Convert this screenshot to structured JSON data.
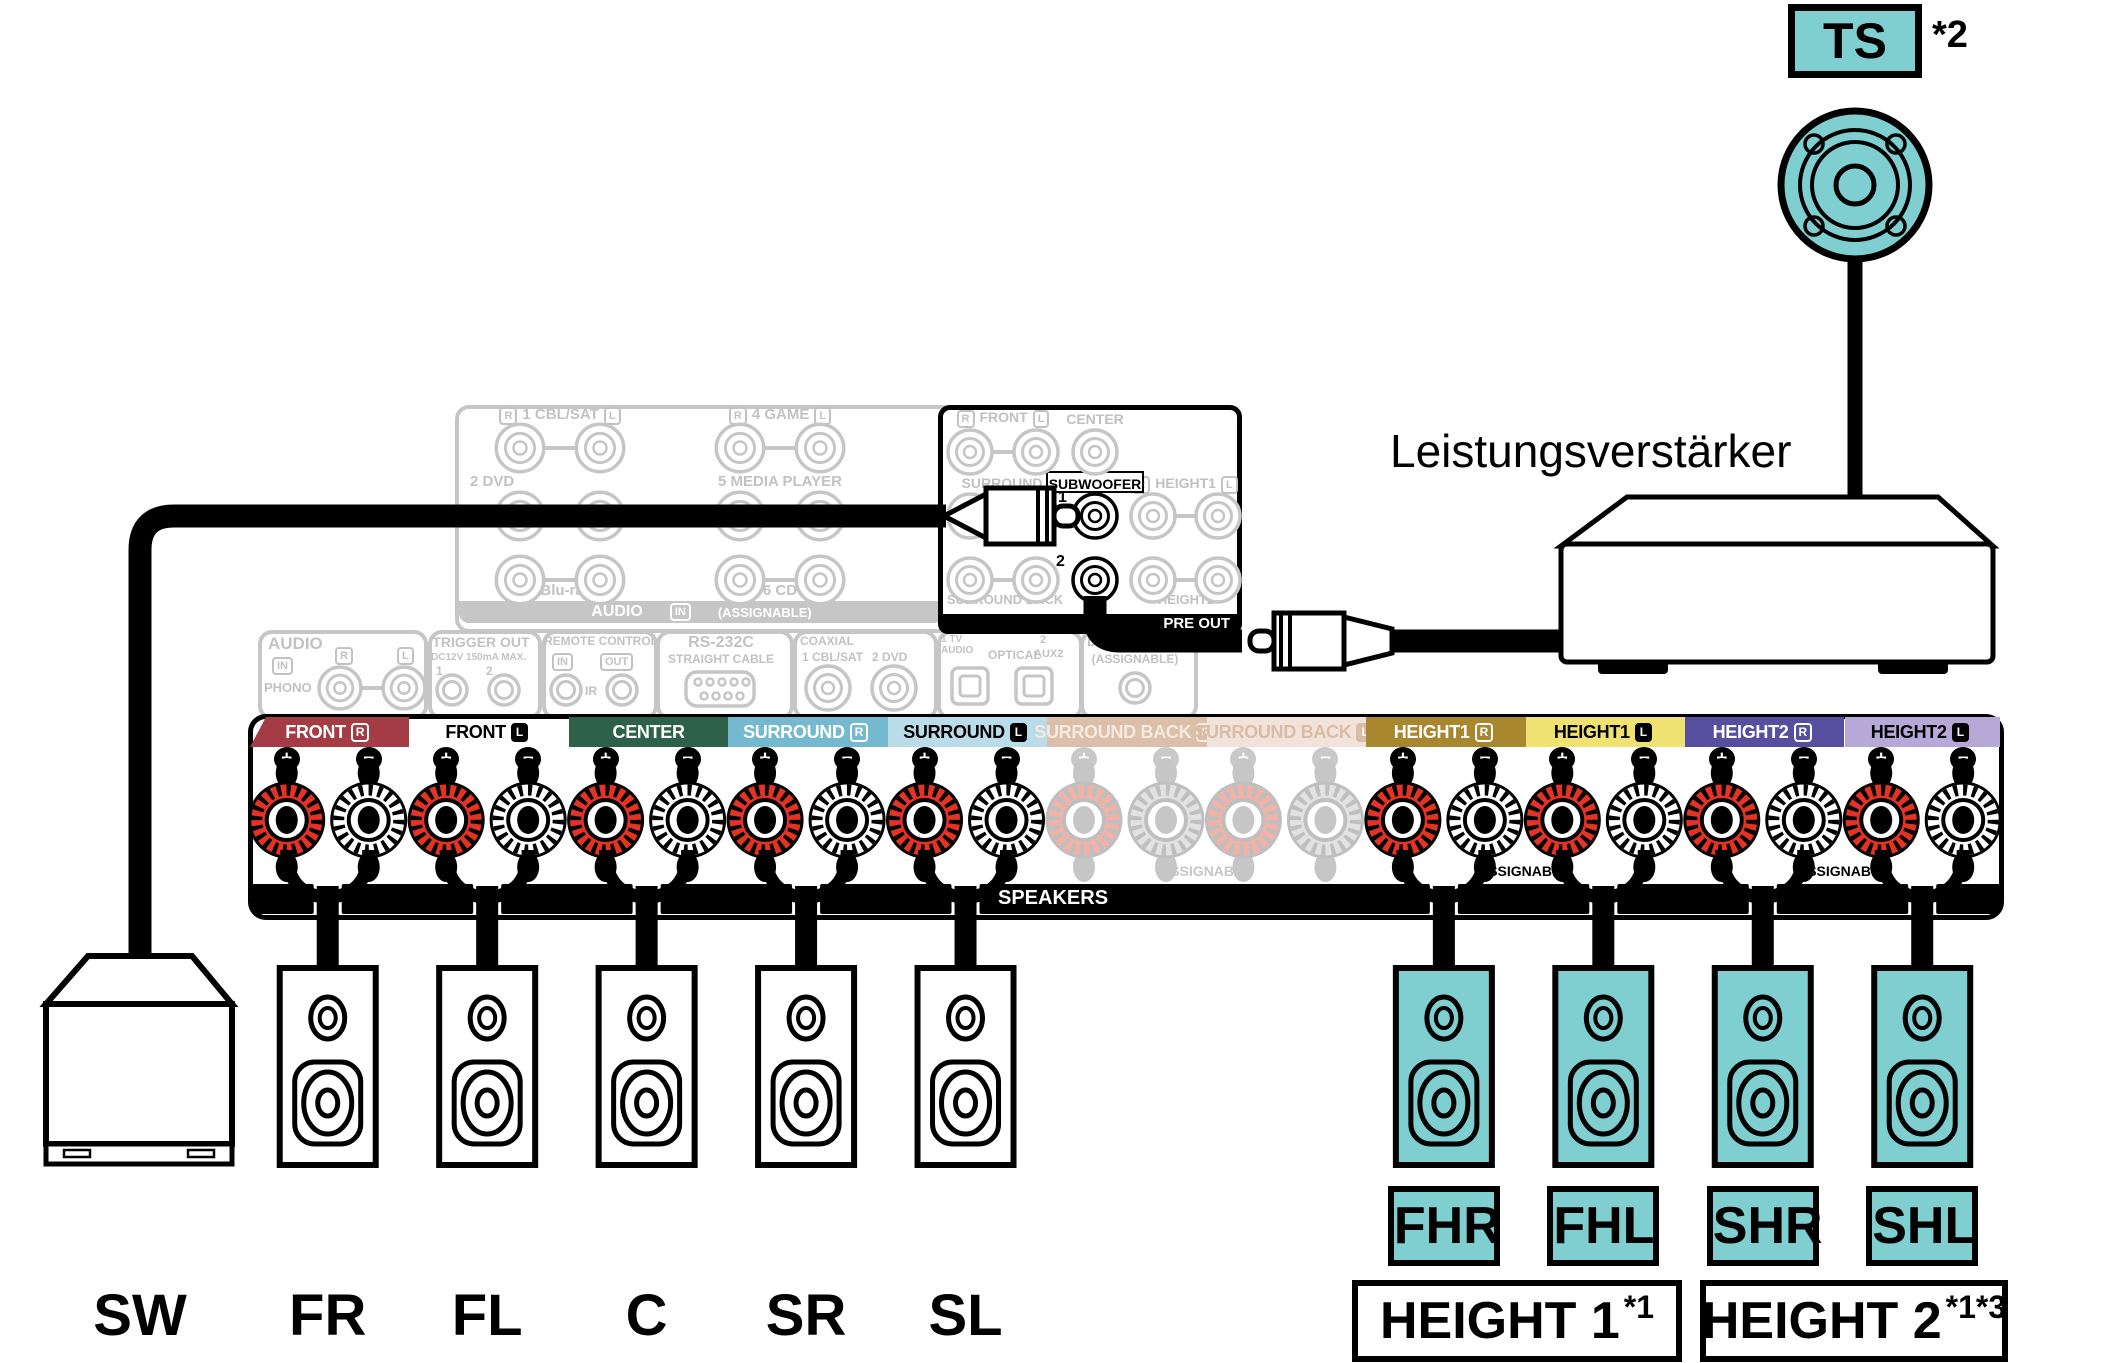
{
  "top_speaker": {
    "label": "TS",
    "footnote": "*2"
  },
  "amplifier_label": "Leistungsverstärker",
  "pre_out": {
    "band": "PRE OUT",
    "front_r": "R",
    "front": "FRONT",
    "front_l": "L",
    "center": "CENTER",
    "surround": "SURROUND",
    "subwoofer": "SUBWOOFER",
    "sub1": "1",
    "sub2": "2",
    "height1_r": "R",
    "height1": "HEIGHT1",
    "height1_l": "L",
    "surround_back": "SURROUND BACK",
    "height2": "HEIGHT2"
  },
  "audio_grid": {
    "r": "R",
    "l": "L",
    "row1_left": "1 CBL/SAT",
    "row1_right": "4 GAME",
    "row2_left": "2 DVD",
    "row2_right": "5 MEDIA PLAYER",
    "row3_left": "3 Blu-ray",
    "row3_right": "6 CD",
    "band_audio": "AUDIO",
    "band_in": "IN",
    "band_assignable": "(ASSIGNABLE)"
  },
  "io_blocks": {
    "audio": {
      "title": "AUDIO",
      "in": "IN",
      "r": "R",
      "l": "L",
      "phono": "PHONO"
    },
    "trigger": {
      "title": "TRIGGER OUT",
      "sub": "DC12V 150mA MAX.",
      "n1": "1",
      "n2": "2"
    },
    "remote": {
      "title": "REMOTE CONTROL",
      "in": "IN",
      "out": "OUT",
      "ir": "IR"
    },
    "rs232c": {
      "title": "RS-232C",
      "sub": "STRAIGHT CABLE"
    },
    "coaxial": {
      "title": "COAXIAL",
      "j1": "1 CBL/SAT",
      "j2": "2 DVD"
    },
    "optical": {
      "l1": "1 TV AUDIO",
      "opt": "OPTICAL",
      "n2": "2",
      "aux": "AUX2"
    },
    "digital": {
      "title": "DIGITAL AUDIO",
      "assignable": "(ASSIGNABLE)"
    }
  },
  "terminal_panel": {
    "speakers_band": "SPEAKERS",
    "assignable_back": "ASSIGNABLE",
    "assignable_h1": "ASSIGNABLE",
    "assignable_h2": "ASSIGNABLE",
    "plus": "+",
    "minus": "−",
    "channels": [
      {
        "label": "FRONT",
        "badge": "R",
        "bg": "#A43C46",
        "fg": "#FFFFFF",
        "badge_bg": "none",
        "badge_fg": "#FFFFFF",
        "badge_border": "#FFFFFF",
        "active": true
      },
      {
        "label": "FRONT",
        "badge": "L",
        "bg": "#FFFFFF",
        "fg": "#000000",
        "badge_bg": "#000000",
        "badge_fg": "#FFFFFF",
        "badge_border": "#000000",
        "active": true
      },
      {
        "label": "CENTER",
        "badge": "",
        "bg": "#2D614A",
        "fg": "#FFFFFF",
        "badge_bg": "none",
        "badge_fg": "#FFFFFF",
        "badge_border": "#FFFFFF",
        "active": true
      },
      {
        "label": "SURROUND",
        "badge": "R",
        "bg": "#74B9CF",
        "fg": "#FFFFFF",
        "badge_bg": "none",
        "badge_fg": "#FFFFFF",
        "badge_border": "#FFFFFF",
        "active": true
      },
      {
        "label": "SURROUND",
        "badge": "L",
        "bg": "#BADCE8",
        "fg": "#000000",
        "badge_bg": "#000000",
        "badge_fg": "#FFFFFF",
        "badge_border": "#000000",
        "active": true
      },
      {
        "label": "SURROUND BACK",
        "badge": "R",
        "bg": "#DCBFA9",
        "fg": "#F4EADF",
        "badge_bg": "none",
        "badge_fg": "#F4EADF",
        "badge_border": "#F4EADF",
        "active": false
      },
      {
        "label": "SURROUND BACK",
        "badge": "L",
        "bg": "#F1E3D9",
        "fg": "#D9BCA7",
        "badge_bg": "#D9BCA7",
        "badge_fg": "#FFFFFF",
        "badge_border": "#D9BCA7",
        "active": false
      },
      {
        "label": "HEIGHT1",
        "badge": "R",
        "bg": "#A9872E",
        "fg": "#FFFFFF",
        "badge_bg": "none",
        "badge_fg": "#FFFFFF",
        "badge_border": "#FFFFFF",
        "active": true
      },
      {
        "label": "HEIGHT1",
        "badge": "L",
        "bg": "#EFE273",
        "fg": "#000000",
        "badge_bg": "#000000",
        "badge_fg": "#FFFFFF",
        "badge_border": "#000000",
        "active": true
      },
      {
        "label": "HEIGHT2",
        "badge": "R",
        "bg": "#564F9F",
        "fg": "#FFFFFF",
        "badge_bg": "none",
        "badge_fg": "#FFFFFF",
        "badge_border": "#FFFFFF",
        "active": true
      },
      {
        "label": "HEIGHT2",
        "badge": "L",
        "bg": "#B7A9D7",
        "fg": "#000000",
        "badge_bg": "#000000",
        "badge_fg": "#FFFFFF",
        "badge_border": "#000000",
        "active": true
      }
    ]
  },
  "bottom_speakers": {
    "main": [
      {
        "code": "SW"
      },
      {
        "code": "FR"
      },
      {
        "code": "FL"
      },
      {
        "code": "C"
      },
      {
        "code": "SR"
      },
      {
        "code": "SL"
      }
    ],
    "height": [
      {
        "code": "FHR"
      },
      {
        "code": "FHL"
      },
      {
        "code": "SHR"
      },
      {
        "code": "SHL"
      }
    ]
  },
  "group_boxes": [
    {
      "label": "HEIGHT 1",
      "sup": "*1"
    },
    {
      "label": "HEIGHT 2",
      "sup": "*1*3"
    }
  ],
  "colors": {
    "teal": "#7FCED0",
    "post_red": "#E23325",
    "faded_gray": "#C6C6C6",
    "black": "#000000"
  }
}
